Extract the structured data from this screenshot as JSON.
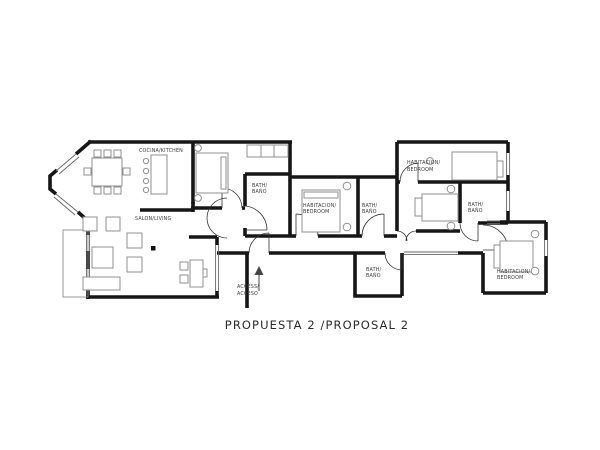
{
  "title": "PROPUESTA 2 /PROPOSAL 2",
  "plan": {
    "rooms": {
      "kitchen": {
        "label": "COCINA/KITCHEN"
      },
      "living": {
        "label": "SALON/LIVING"
      },
      "bath_top": {
        "line1": "BATH/",
        "line2": "BAÑO"
      },
      "bedroom_middle": {
        "line1": "HABITACION/",
        "line2": "BEDROOM"
      },
      "bath_middle": {
        "line1": "BATH/",
        "line2": "BAÑO"
      },
      "bedroom_top_right": {
        "line1": "HABITACION/",
        "line2": "BEDROOM"
      },
      "bath_right": {
        "line1": "BATH/",
        "line2": "BAÑO"
      },
      "bath_lower": {
        "line1": "BATH/",
        "line2": "BAÑO"
      },
      "bedroom_bottom_right": {
        "line1": "HABITACION/",
        "line2": "BEDROOM"
      }
    },
    "entrance": {
      "line1": "ACCESS/",
      "line2": "ACCESO"
    },
    "colors": {
      "wall": "#161616",
      "furniture": "#8f8f8f",
      "label": "#3a3a3a",
      "door": "#333333"
    }
  }
}
